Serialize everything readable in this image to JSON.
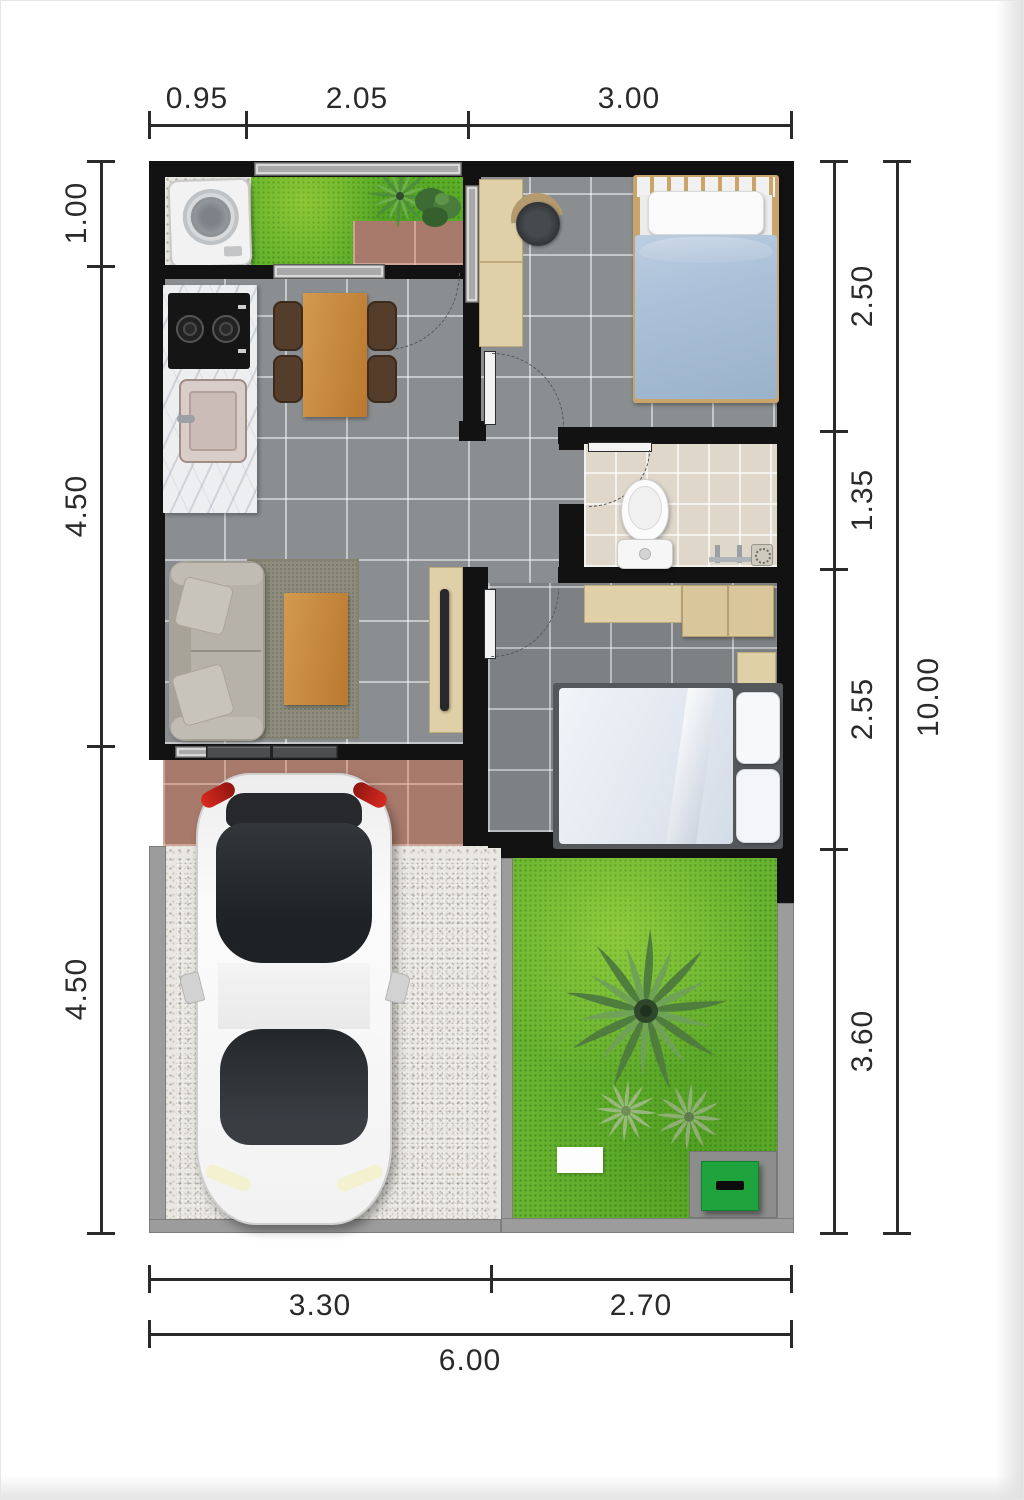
{
  "title": "house-floor-plan",
  "dimensions": {
    "top": [
      "0.95",
      "2.05",
      "3.00"
    ],
    "left": [
      "1.00",
      "4.50",
      "4.50"
    ],
    "right": [
      "2.50",
      "1.35",
      "2.55",
      "3.60"
    ],
    "right_total": "10.00",
    "bottom": [
      "3.30",
      "2.70"
    ],
    "bottom_total": "6.00"
  },
  "colors": {
    "wall": "#121212",
    "dim": "#2a2a2a",
    "floor": "#8b8e91",
    "floor_dark": "#7e8184",
    "bath_floor": "#ded7ca",
    "grass": "#62b22c",
    "garden_grass": "#68b430",
    "terracotta": "#a87a6c",
    "wood": "#d39a4e",
    "beige": "#e0d0a8",
    "sofa": "#b7b2a9",
    "bed_blue": "#a9c0d8",
    "bed_white": "#e9edf3",
    "gravel": "#e9e7e1",
    "slab": "#97999b",
    "curb": "#9c9c9c",
    "car_body": "#f4f4f4",
    "glass": "#2c2f33",
    "tail_red": "#d92b20",
    "utility_green": "#1fa33c"
  },
  "elements": [
    "washing-machine",
    "service-grass",
    "kitchen-counter",
    "stove",
    "kitchen-sink",
    "dining-table",
    "dining-chair",
    "sofa",
    "rug",
    "coffee-table",
    "tv-console",
    "desk",
    "desk-chair",
    "single-bed",
    "toilet",
    "shower-faucet",
    "floor-drain",
    "wardrobe",
    "nightstand",
    "double-bed",
    "front-door",
    "window",
    "car",
    "carport-slabs",
    "garden-lawn",
    "palm-tree",
    "shrub",
    "stepping-stone",
    "utility-box"
  ]
}
